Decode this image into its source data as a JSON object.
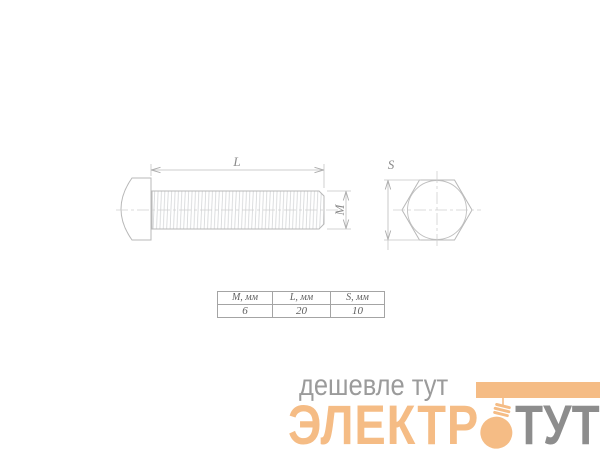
{
  "drawing": {
    "labels": {
      "length": "L",
      "diameter": "M",
      "across_flats": "S"
    }
  },
  "table": {
    "headers": [
      "M, мм",
      "L, мм",
      "S, мм"
    ],
    "values": [
      "6",
      "20",
      "10"
    ]
  },
  "logo": {
    "tagline": "дешевле тут",
    "brand_prefix": "ЭЛЕКТР",
    "brand_suffix": "ТУТ",
    "colors": {
      "brand_orange": "#f5bc85",
      "tagline_gray": "#9b9b9b",
      "brand_gray": "#8d8d8d"
    }
  }
}
